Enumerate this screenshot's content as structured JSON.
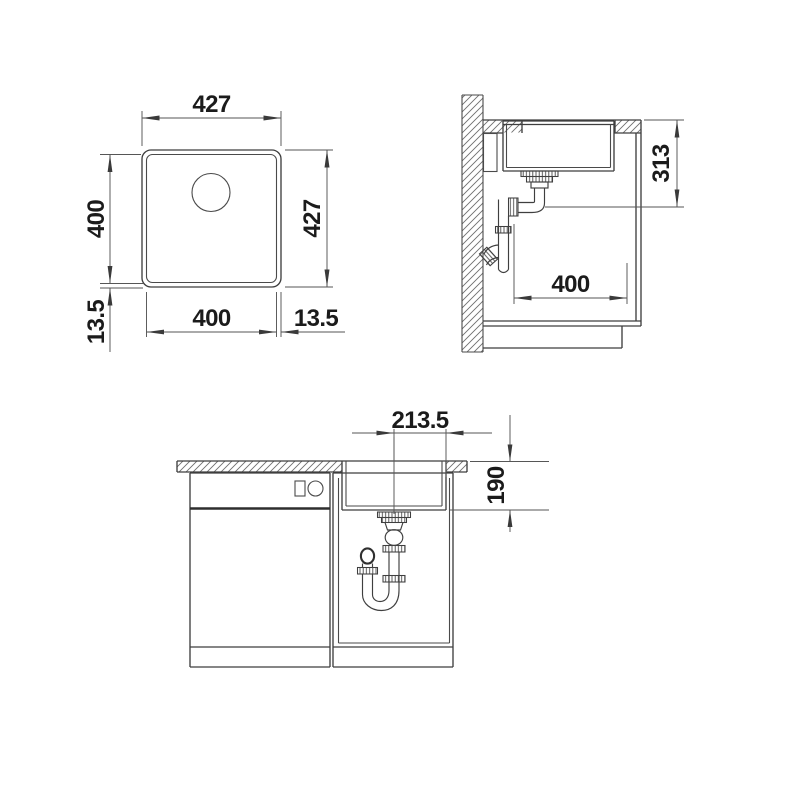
{
  "drawing": {
    "type": "sink-installation-technical-drawing",
    "dims": {
      "plan_top": "427",
      "plan_right": "427",
      "plan_left": "400",
      "plan_left_rim": "13.5",
      "plan_bottom": "400",
      "plan_bottom_rim": "13.5",
      "side_height": "313",
      "side_depth": "400",
      "front_half_width": "213.5",
      "front_depth": "190"
    },
    "colors": {
      "line": "#3f3f3f",
      "dimension_line": "#565656",
      "text": "#1b1b1b",
      "background": "#ffffff"
    }
  }
}
